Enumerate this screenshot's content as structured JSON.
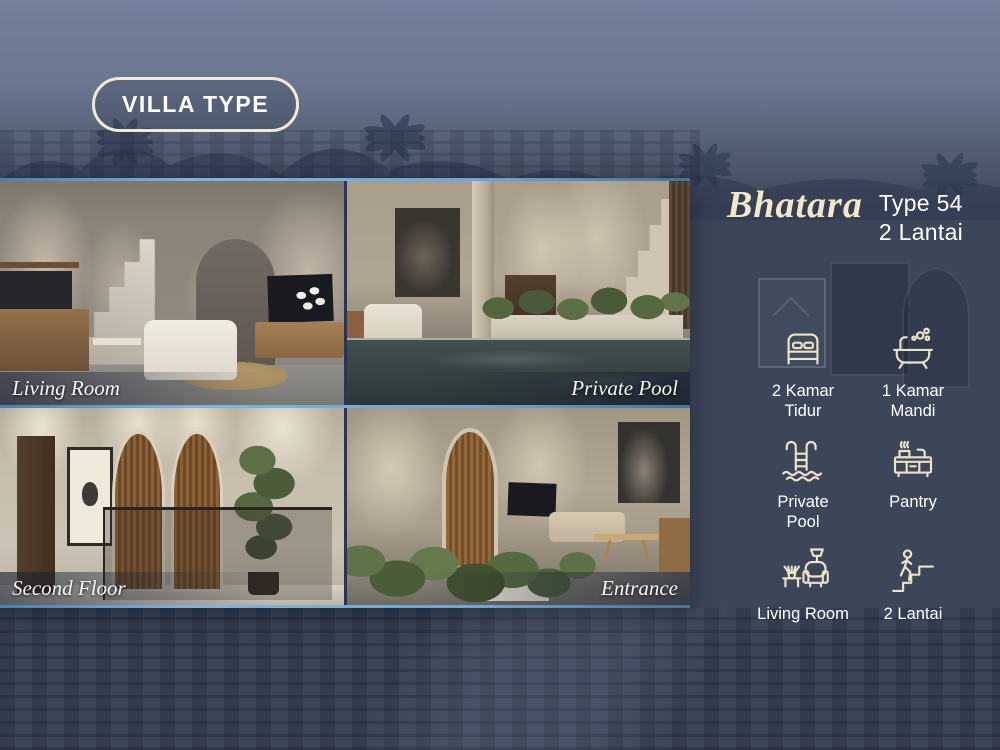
{
  "colors": {
    "background_navy": "#3c4659",
    "sky_blue_gray": "#6a778f",
    "accent_cream": "#f1e9d4",
    "title_cream": "#f2e7c7",
    "accent_blue_line": "#6aa6d6",
    "text_white": "#ffffff",
    "caption_bar": "rgba(22,30,50,0.62)"
  },
  "badge": {
    "label": "VILLA TYPE"
  },
  "title": {
    "name": "Bhatara",
    "type": "Type 54",
    "floors": "2 Lantai"
  },
  "photos": [
    {
      "caption": "Living Room"
    },
    {
      "caption": "Private Pool"
    },
    {
      "caption": "Second Floor"
    },
    {
      "caption": "Entrance"
    }
  ],
  "features": [
    {
      "icon": "bed-icon",
      "label": "2 Kamar\nTidur"
    },
    {
      "icon": "bathtub-icon",
      "label": "1 Kamar\nMandi"
    },
    {
      "icon": "pool-ladder-icon",
      "label": "Private\nPool"
    },
    {
      "icon": "pantry-icon",
      "label": "Pantry"
    },
    {
      "icon": "living-room-icon",
      "label": "Living Room"
    },
    {
      "icon": "stairs-icon",
      "label": "2 Lantai"
    }
  ]
}
